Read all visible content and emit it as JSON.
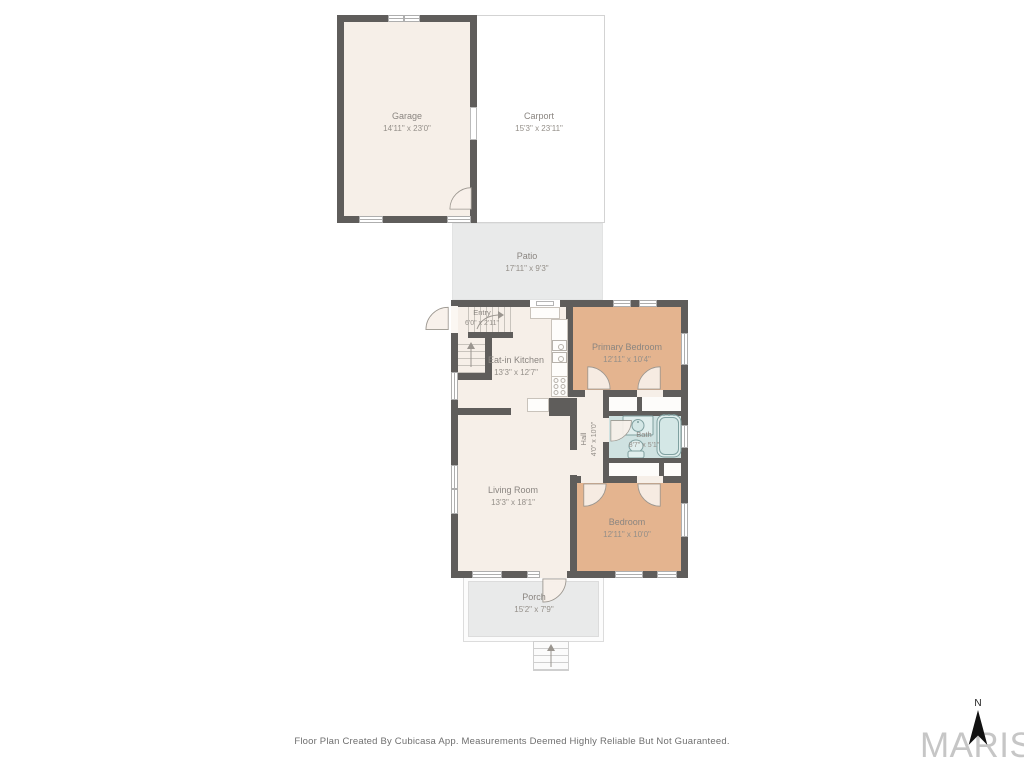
{
  "plan": {
    "rooms": {
      "garage": {
        "name": "Garage",
        "dims": "14'11\" x 23'0\""
      },
      "carport": {
        "name": "Carport",
        "dims": "15'3\" x 23'11\""
      },
      "patio": {
        "name": "Patio",
        "dims": "17'11\" x 9'3\""
      },
      "entry": {
        "name": "Entry",
        "dims": "6'0\" x 2'11\""
      },
      "kitchen": {
        "name": "Eat-in Kitchen",
        "dims": "13'3\" x 12'7\""
      },
      "primary_bedroom": {
        "name": "Primary Bedroom",
        "dims": "12'11\" x 10'4\""
      },
      "hall": {
        "name": "Hall",
        "dims": "4'0\" x 10'0\""
      },
      "bath": {
        "name": "Bath",
        "dims": "8'7\" x 5'1\""
      },
      "living_room": {
        "name": "Living Room",
        "dims": "13'3\" x 18'1\""
      },
      "bedroom": {
        "name": "Bedroom",
        "dims": "12'11\" x 10'0\""
      },
      "porch": {
        "name": "Porch",
        "dims": "15'2\" x 7'9\""
      }
    },
    "footer": "Floor Plan Created By Cubicasa App. Measurements Deemed Highly Reliable But Not Guaranteed.",
    "compass": {
      "north_label": "N"
    },
    "brand": {
      "logo_text": "MARIS"
    },
    "colors": {
      "wall": "#5f5d5b",
      "interior": "#f6efe8",
      "bedroom_fill": "#e4b48f",
      "bath_fill": "#cfe2e1",
      "outdoor_fill": "#e9eaea",
      "carport_fill": "#ffffff"
    }
  }
}
